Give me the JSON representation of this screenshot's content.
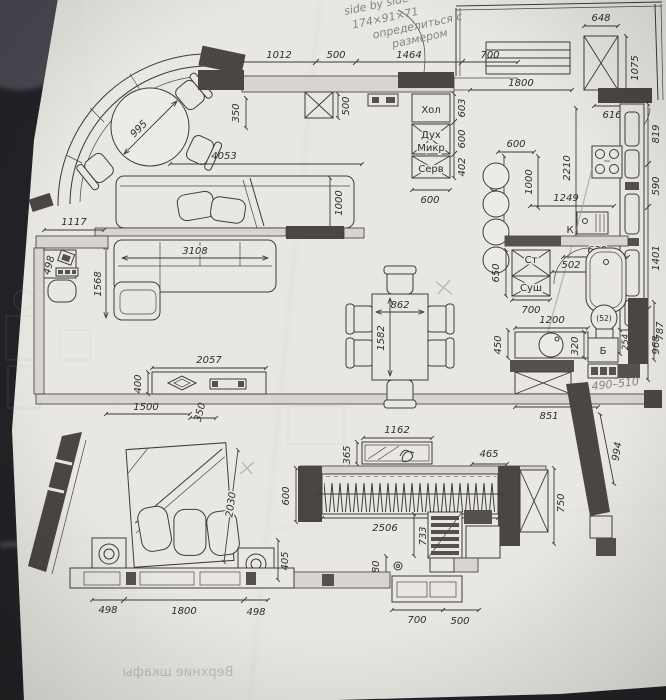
{
  "document": {
    "type": "apartment floor plan photo",
    "palette": {
      "paper": "#e9e7e2",
      "ink": "#3b3a37",
      "wall": "#4a4642",
      "pencil": "#82828c",
      "bleed_ink": "#9aa0b2",
      "background": "#232327"
    }
  },
  "note": {
    "l1": "side by side",
    "l2": "174×91×71",
    "l3": "определиться с",
    "l4": "размером"
  },
  "pencil": {
    "range": "490–510"
  },
  "appliances": {
    "fridge": "Хол",
    "oven": "Дух",
    "microwave": "Микр",
    "server": "Серв",
    "washer": "Ст",
    "dryer": "Суш",
    "sink": "К",
    "boiler": "Б",
    "toilet_seat": "(52)",
    "toilet_depth": "254"
  },
  "dims": {
    "top_1012": "1012",
    "top_500": "500",
    "top_1464": "1464",
    "top_700": "700",
    "top_350": "350",
    "corridor_500": "500",
    "balc_648": "648",
    "balc_1075": "1075",
    "balc_1800": "1800",
    "balc_616": "616",
    "col_603": "603",
    "col_600": "600",
    "col_402": "402",
    "col_600b": "600",
    "kit_819": "819",
    "kit_590": "590",
    "kit_1401": "1401",
    "kit_2210": "2210",
    "kit_600": "600",
    "kit_1000": "1000",
    "kit_1600": "1600",
    "kit_1249": "1249",
    "bath_630": "630",
    "bath_502": "502",
    "bath_650": "650",
    "bath_700": "700",
    "bath_968": "968",
    "wc_1200": "1200",
    "wc_450": "450",
    "wc_320": "320",
    "wc_550": "550",
    "wc_851": "851",
    "wc_787": "787",
    "wc_994": "994",
    "bay_995": "995",
    "liv_4053": "4053",
    "liv_1000": "1000",
    "liv_1117": "1117",
    "liv_498": "498",
    "liv_3108": "3108",
    "liv_1568": "1568",
    "liv_2057": "2057",
    "liv_400": "400",
    "liv_1500": "1500",
    "liv_350": "350",
    "tbl_862": "862",
    "tbl_1582": "1582",
    "war_1162": "1162",
    "war_365": "365",
    "war_465": "465",
    "war_600": "600",
    "war_750": "750",
    "war_2506": "2506",
    "war_733": "733",
    "war_380": "380",
    "war_700": "700",
    "war_500": "500",
    "bed_2030": "2030",
    "bed_405": "405",
    "bed_498l": "498",
    "bed_1800": "1800",
    "bed_498r": "498"
  },
  "bleed": {
    "upper_cabinets": "Верхние шкафы"
  }
}
